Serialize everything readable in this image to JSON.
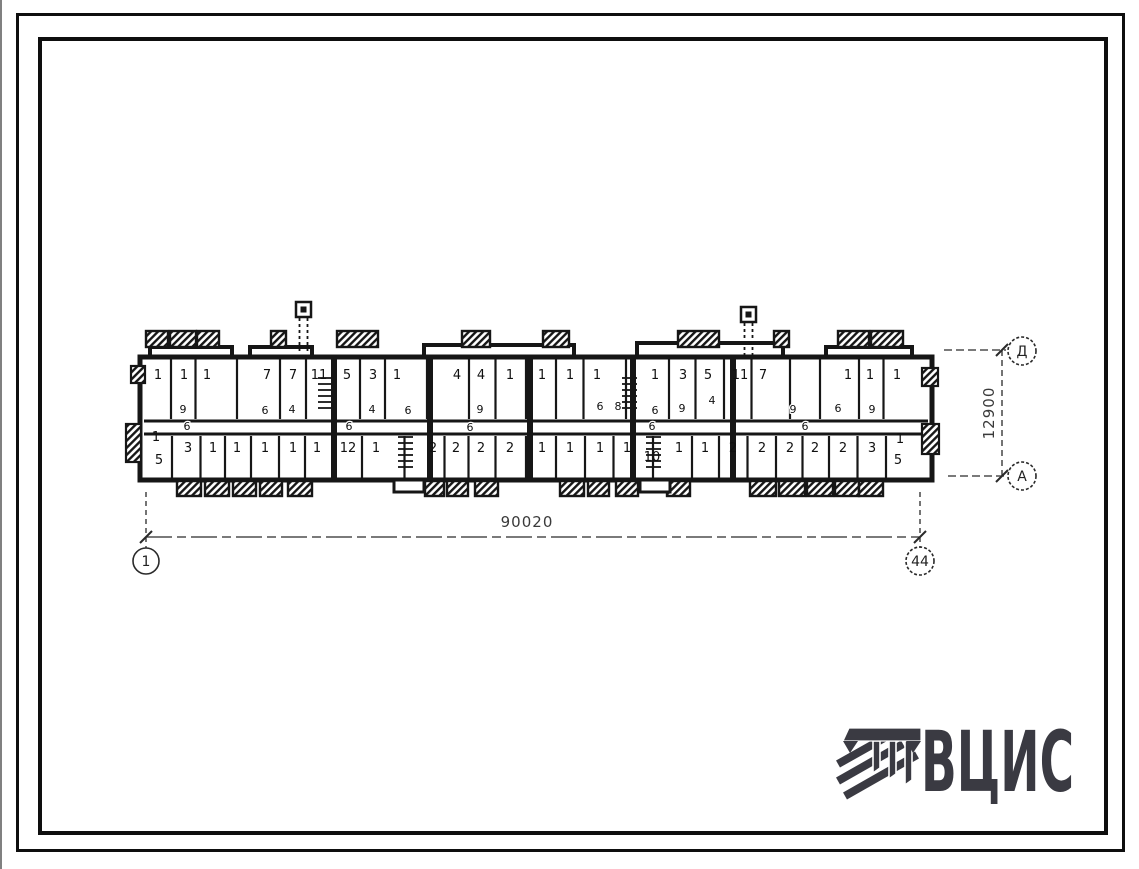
{
  "sheet": {
    "background": "#ffffff",
    "ink": "#161616"
  },
  "logo": {
    "text": "ВЦИС",
    "color": "#3a3a42",
    "emblem": "hatched-beam-mark"
  },
  "drawing": {
    "dimensions": {
      "horizontal": "90020",
      "vertical": "12900"
    },
    "axes": {
      "bottom_left": "1",
      "bottom_right": "44",
      "right_top": "Д",
      "right_bottom": "А"
    },
    "plan": {
      "top_rooms": [
        {
          "n": "1",
          "x": 158
        },
        {
          "n": "1",
          "x": 184
        },
        {
          "n": "1",
          "x": 207
        },
        {
          "n": "7",
          "x": 267
        },
        {
          "n": "7",
          "x": 293
        },
        {
          "n": "11",
          "x": 319
        },
        {
          "n": "5",
          "x": 347
        },
        {
          "n": "3",
          "x": 373
        },
        {
          "n": "1",
          "x": 397
        },
        {
          "n": "4",
          "x": 457
        },
        {
          "n": "4",
          "x": 481
        },
        {
          "n": "1",
          "x": 510
        },
        {
          "n": "1",
          "x": 542
        },
        {
          "n": "1",
          "x": 570
        },
        {
          "n": "1",
          "x": 597
        },
        {
          "n": "1",
          "x": 655
        },
        {
          "n": "3",
          "x": 683
        },
        {
          "n": "5",
          "x": 708
        },
        {
          "n": "11",
          "x": 740
        },
        {
          "n": "7",
          "x": 763
        },
        {
          "n": "1",
          "x": 848
        },
        {
          "n": "1",
          "x": 870
        },
        {
          "n": "1",
          "x": 897
        }
      ],
      "mid_labels": [
        {
          "n": "9",
          "x": 183,
          "y": 413
        },
        {
          "n": "6",
          "x": 265,
          "y": 414
        },
        {
          "n": "4",
          "x": 292,
          "y": 413
        },
        {
          "n": "4",
          "x": 372,
          "y": 413
        },
        {
          "n": "6",
          "x": 408,
          "y": 414
        },
        {
          "n": "9",
          "x": 480,
          "y": 413
        },
        {
          "n": "6",
          "x": 600,
          "y": 410
        },
        {
          "n": "8",
          "x": 618,
          "y": 410
        },
        {
          "n": "6",
          "x": 655,
          "y": 414
        },
        {
          "n": "9",
          "x": 682,
          "y": 412
        },
        {
          "n": "4",
          "x": 712,
          "y": 404
        },
        {
          "n": "9",
          "x": 793,
          "y": 413
        },
        {
          "n": "6",
          "x": 838,
          "y": 412
        },
        {
          "n": "9",
          "x": 872,
          "y": 413
        }
      ],
      "corridor_labels": [
        {
          "n": "6",
          "x": 187,
          "y": 430
        },
        {
          "n": "6",
          "x": 349,
          "y": 430
        },
        {
          "n": "6",
          "x": 470,
          "y": 431
        },
        {
          "n": "6",
          "x": 652,
          "y": 430
        },
        {
          "n": "6",
          "x": 805,
          "y": 430
        }
      ],
      "bottom_rooms": [
        {
          "n": "1",
          "x": 156,
          "y": 441
        },
        {
          "n": "5",
          "x": 159,
          "y": 464,
          "sub": true
        },
        {
          "n": "3",
          "x": 188
        },
        {
          "n": "1",
          "x": 213
        },
        {
          "n": "1",
          "x": 237
        },
        {
          "n": "1",
          "x": 265
        },
        {
          "n": "1",
          "x": 293
        },
        {
          "n": "1",
          "x": 317
        },
        {
          "n": "12",
          "x": 348
        },
        {
          "n": "1",
          "x": 376
        },
        {
          "n": "2",
          "x": 433
        },
        {
          "n": "2",
          "x": 456
        },
        {
          "n": "2",
          "x": 481
        },
        {
          "n": "2",
          "x": 510
        },
        {
          "n": "1",
          "x": 542
        },
        {
          "n": "1",
          "x": 570
        },
        {
          "n": "1",
          "x": 600
        },
        {
          "n": "1",
          "x": 627
        },
        {
          "n": "10",
          "x": 652,
          "y": 461,
          "sub": true
        },
        {
          "n": "1",
          "x": 679
        },
        {
          "n": "1",
          "x": 705
        },
        {
          "n": "2",
          "x": 733
        },
        {
          "n": "2",
          "x": 762
        },
        {
          "n": "2",
          "x": 790
        },
        {
          "n": "2",
          "x": 815
        },
        {
          "n": "2",
          "x": 843
        },
        {
          "n": "3",
          "x": 872
        },
        {
          "n": "1",
          "x": 900,
          "y": 443
        },
        {
          "n": "5",
          "x": 898,
          "y": 464,
          "sub": true
        }
      ]
    }
  }
}
